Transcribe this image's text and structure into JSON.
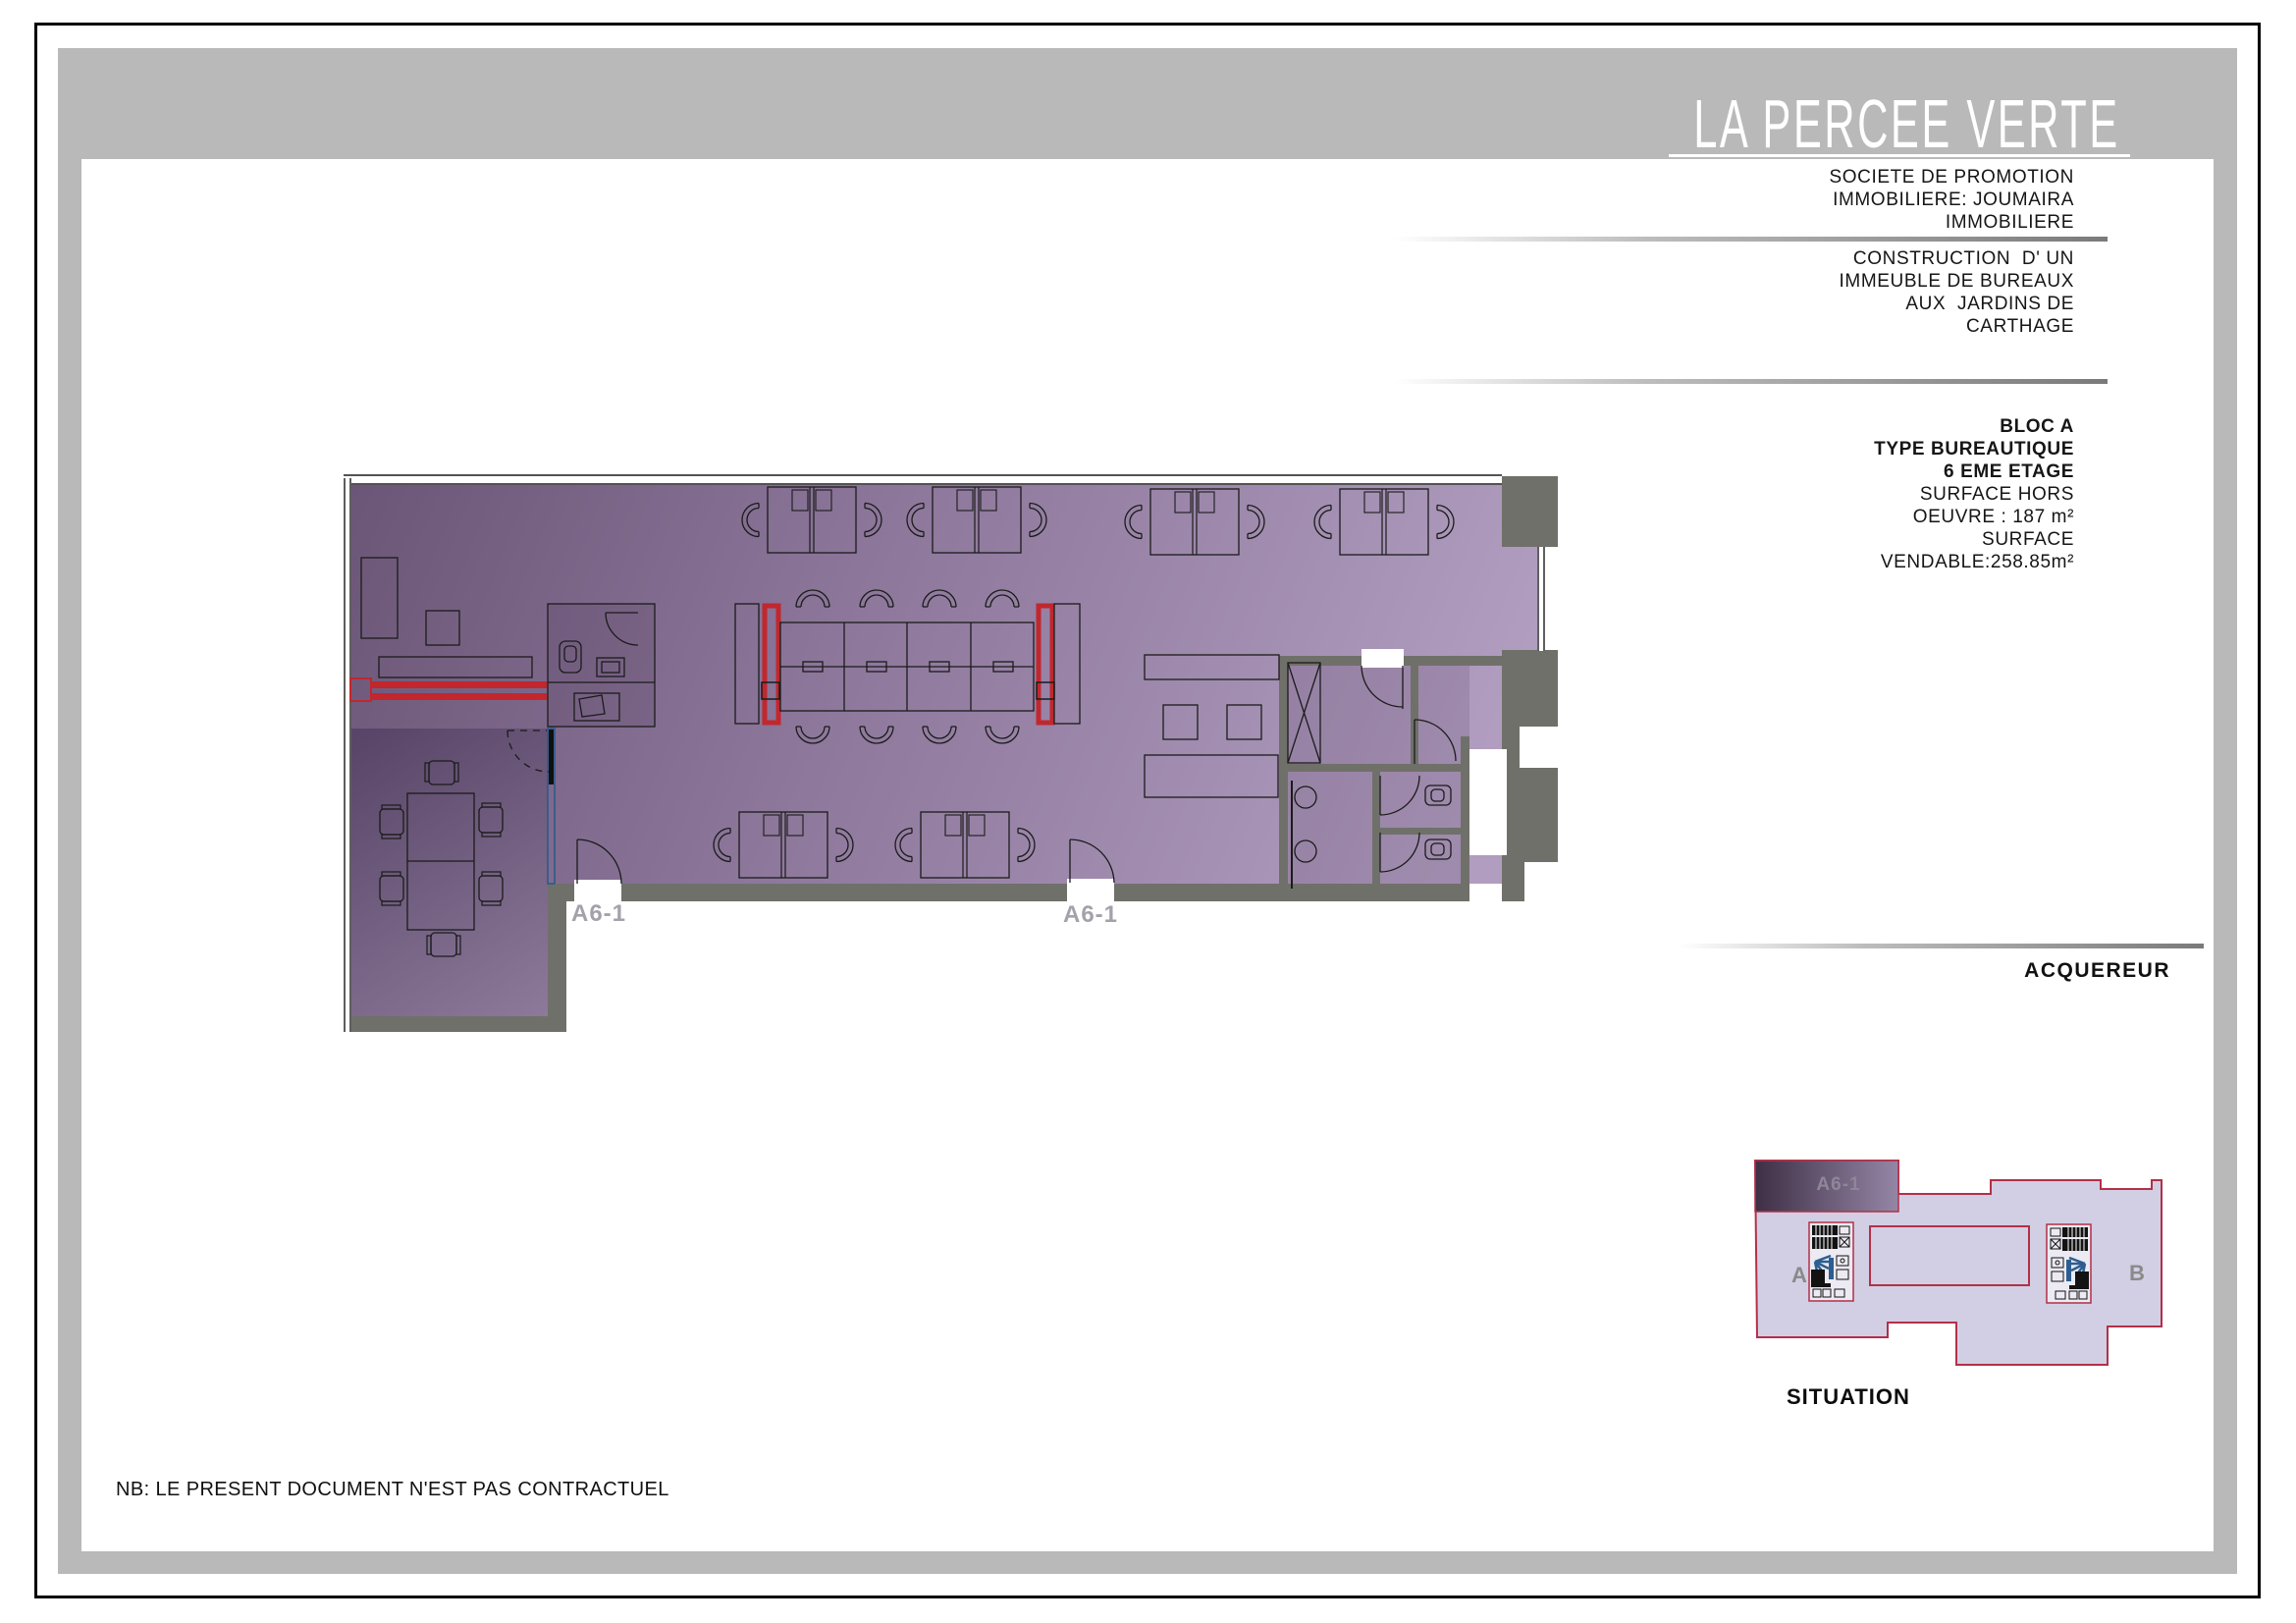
{
  "header": {
    "title": "LA PERCEE VERTE"
  },
  "sidebar": {
    "company_lines": [
      "SOCIETE DE PROMOTION",
      "IMMOBILIERE: JOUMAIRA",
      "IMMOBILIERE"
    ],
    "project_lines": [
      "CONSTRUCTION  D' UN",
      "IMMEUBLE DE BUREAUX",
      "AUX  JARDINS DE",
      "CARTHAGE"
    ],
    "unit_bold_lines": [
      "BLOC A",
      "TYPE BUREAUTIQUE",
      "6 EME ETAGE"
    ],
    "unit_lines": [
      "SURFACE HORS",
      "OEUVRE : 187 m²",
      "SURFACE",
      "VENDABLE:258.85m²"
    ],
    "buyer_label": "ACQUEREUR"
  },
  "plan": {
    "unit_labels": [
      "A6-1",
      "A6-1"
    ]
  },
  "situation": {
    "caption": "SITUATION",
    "unit_label": "A6-1",
    "block_a_label": "A",
    "block_b_label": "B"
  },
  "note": "NB: LE PRESENT DOCUMENT N'EST PAS CONTRACTUEL",
  "colors": {
    "frame_gray": "#b9b9b9",
    "wall_gray": "#70706a",
    "highlight_red": "#c1272d",
    "partition_blue": "#2a5a8c",
    "office_purple_dark": "#6b5677",
    "office_purple_light": "#b09dbf",
    "situation_lavender": "#d2cfe4",
    "situation_outline_red": "#b23048"
  }
}
